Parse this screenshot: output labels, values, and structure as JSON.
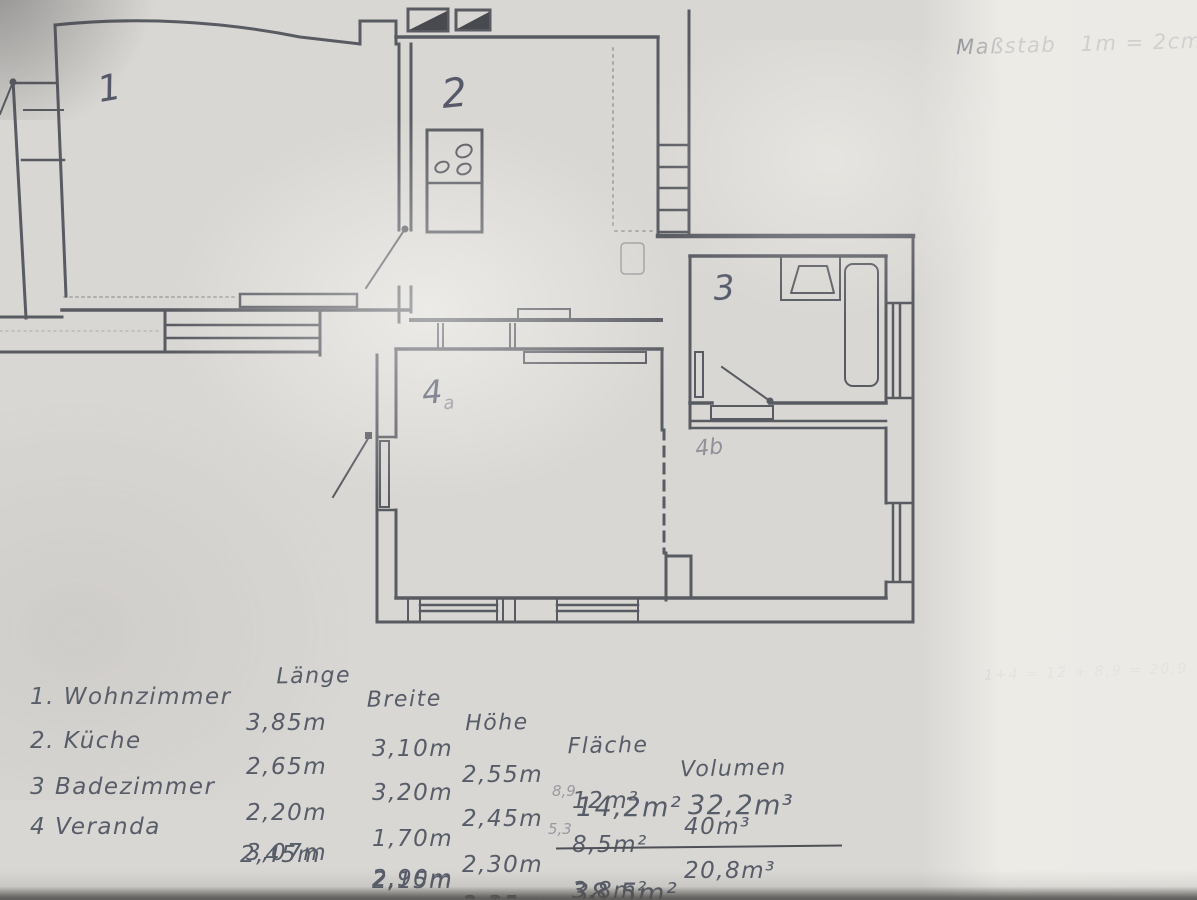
{
  "document": {
    "scale_note": "Maßstab   1m = 2cm",
    "side_calc_note": "1+4 = 12 + 8,9 = 20,9"
  },
  "plan": {
    "rooms": [
      {
        "id": "1",
        "label": "1"
      },
      {
        "id": "2",
        "label": "2"
      },
      {
        "id": "3",
        "label": "3"
      },
      {
        "id": "4a",
        "label": "4",
        "sub": "a"
      },
      {
        "id": "4b",
        "pencil_label": "4b"
      }
    ]
  },
  "table": {
    "headers": {
      "laenge": "Länge",
      "breite": "Breite",
      "hoehe": "Höhe",
      "flaeche": "Fläche",
      "volumen": "Volumen"
    },
    "rows": [
      {
        "name": "1. Wohnzimmer",
        "laenge": "3,85m",
        "breite": "3,10m",
        "hoehe": "2,55m",
        "flaeche": "12m²",
        "volumen": "40m³",
        "pencil_note": ""
      },
      {
        "name": "2. Küche",
        "laenge": "2,65m",
        "breite": "3,20m",
        "hoehe": "2,45m",
        "flaeche": "8,5m²",
        "volumen": "20,8m³",
        "pencil_note": ""
      },
      {
        "name": "3 Badezimmer",
        "laenge": "2,20m",
        "breite": "1,70m",
        "hoehe": "2,30m",
        "flaeche": "3,8m²",
        "volumen": "8,6m³",
        "pencil_note": ""
      },
      {
        "name": "4 Veranda",
        "laenge": "3,07m",
        "breite": "2,90m",
        "hoehe": "2,35m",
        "flaeche": "14,2m²",
        "volumen": "32,2m³",
        "pencil_note": "8,9"
      },
      {
        "name": "",
        "laenge": "2,45m",
        "breite": "2,15m",
        "hoehe": "2,15m",
        "flaeche": "",
        "volumen": "",
        "pencil_note": "5,3"
      }
    ],
    "totals": {
      "flaeche": "38,5m²",
      "volumen": "101,6m³"
    }
  }
}
